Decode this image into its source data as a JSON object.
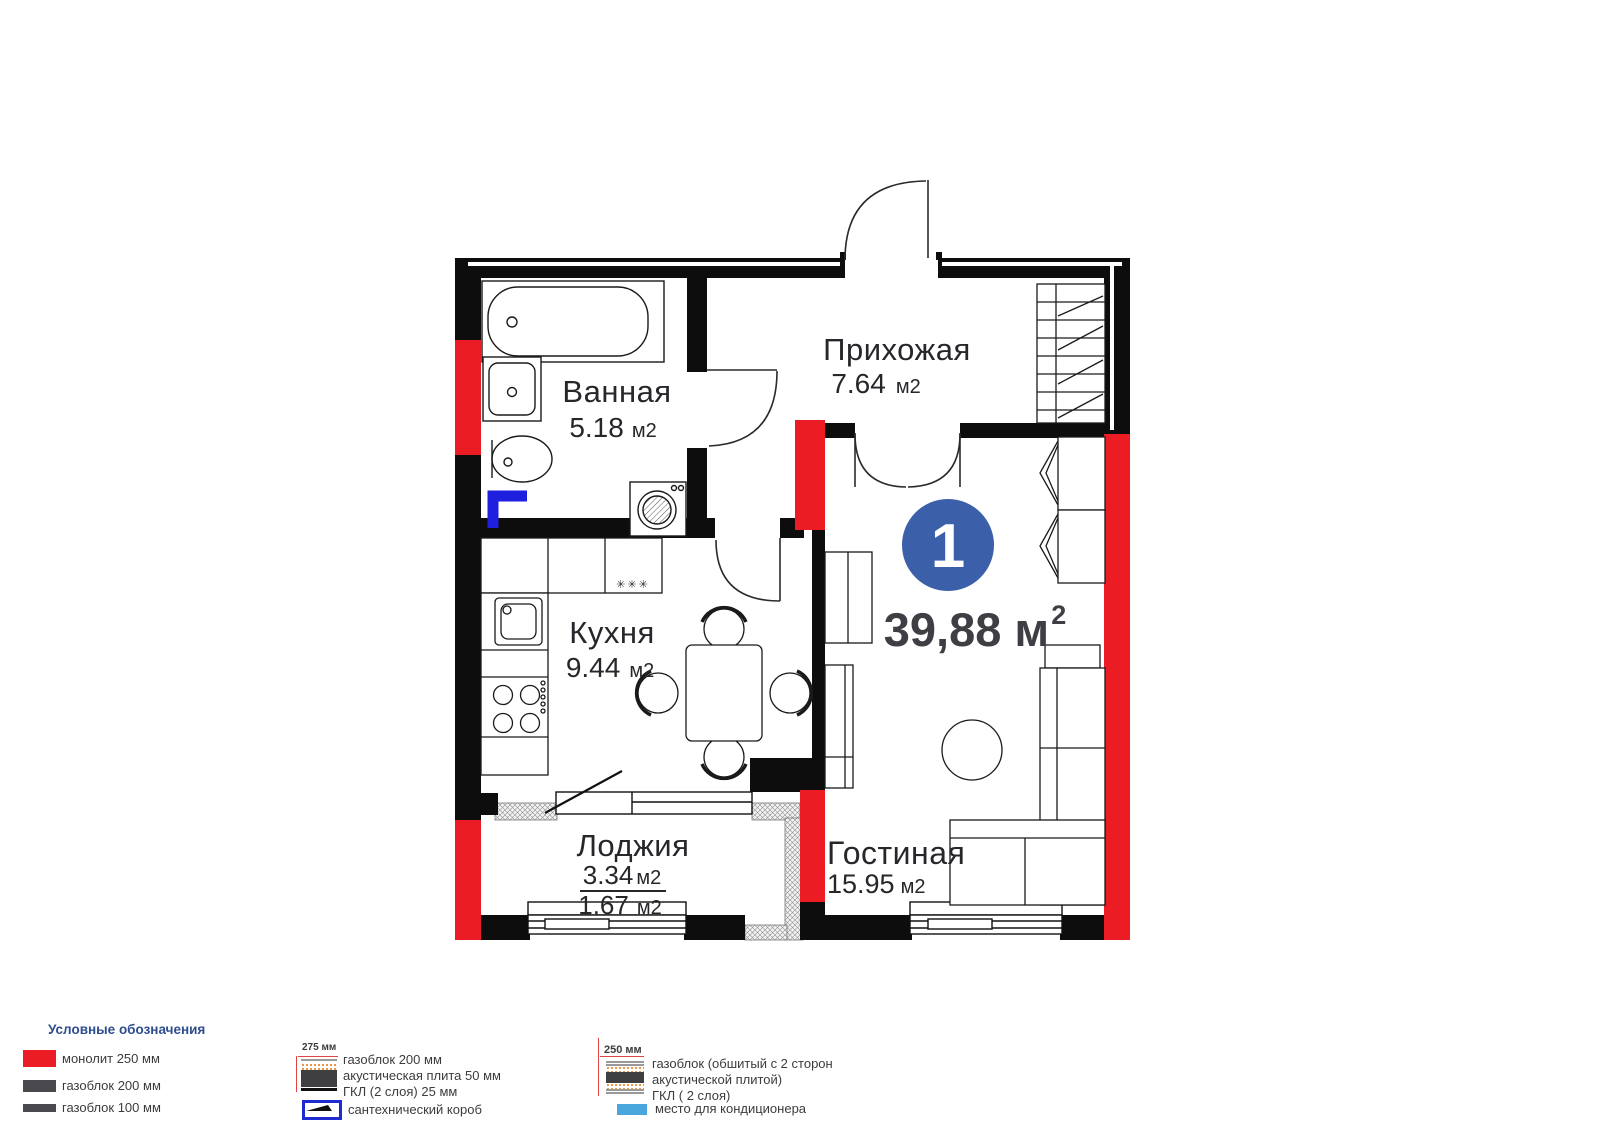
{
  "plan": {
    "badge": {
      "number": "1",
      "total_area": "39,88 м",
      "sup": "2"
    },
    "rooms": {
      "bathroom": {
        "name": "Ванная",
        "area": "5.18",
        "unit": "м2"
      },
      "hallway": {
        "name": "Прихожая",
        "area": "7.64",
        "unit": "м2"
      },
      "kitchen": {
        "name": "Кухня",
        "area": "9.44",
        "unit": "м2"
      },
      "loggia": {
        "name": "Лоджия",
        "area": "3.34",
        "unit": "м2",
        "area_half": "1.67",
        "unit_half": "м2"
      },
      "living": {
        "name": "Гостиная",
        "area": "15.95",
        "unit": "м2"
      }
    },
    "kitchen_vent_marker": "✳✳✳"
  },
  "legend": {
    "title": "Условные обозначения",
    "left_items": [
      {
        "label": "монолит 250 мм",
        "swatch": "red"
      },
      {
        "label": "газоблок 200 мм",
        "swatch": "dark"
      },
      {
        "label": "газоблок 100 мм",
        "swatch": "dark-thin"
      }
    ],
    "middle": {
      "dim": "275 мм",
      "lines": [
        "газоблок 200 мм",
        "акустическая плита 50 мм",
        "ГКЛ (2 слоя) 25 мм"
      ],
      "box_label": "сантехнический короб"
    },
    "right": {
      "dim": "250 мм",
      "lines": [
        "газоблок (обшитый с 2 сторон",
        "акустической плитой)",
        "ГКЛ ( 2 слоя)"
      ],
      "ac_label": "место для кондиционера"
    }
  },
  "colors": {
    "wall_black": "#0d0d0d",
    "monolith_red": "#ec1c24",
    "sanitary_blue": "#1f1fe0",
    "badge_blue": "#3b5fa9",
    "legend_header_blue": "#2e4d8e",
    "ac_blue": "#4aa7dd"
  }
}
